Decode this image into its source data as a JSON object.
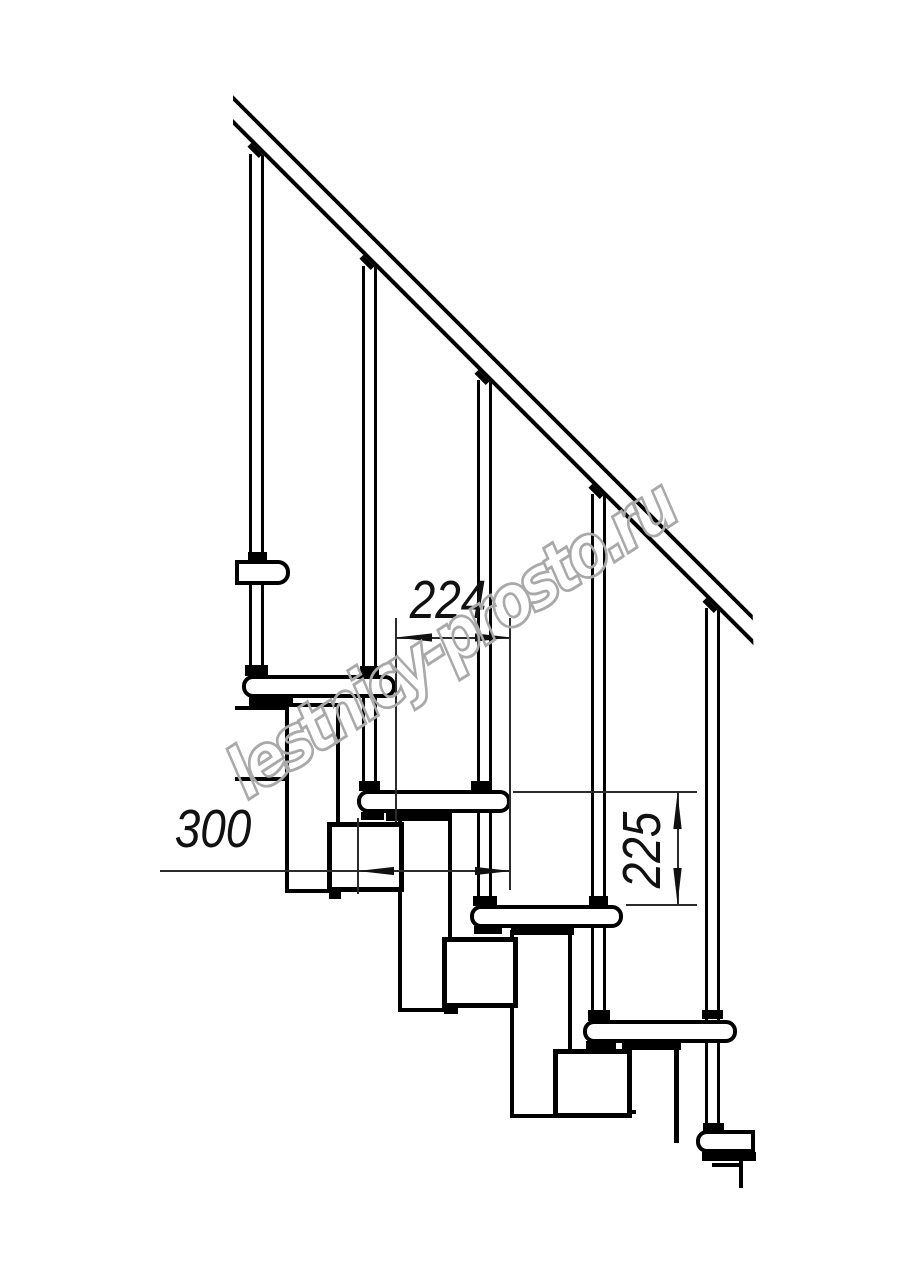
{
  "drawing": {
    "title": "Modular staircase side-view technical drawing",
    "background_color": "#ffffff",
    "line_color": "#000000",
    "dimension_color": "#2b2b2b",
    "dimensions": {
      "step_run": {
        "value": "224",
        "orientation": "horizontal"
      },
      "tread_depth": {
        "value": "300",
        "orientation": "horizontal"
      },
      "step_rise": {
        "value": "225",
        "orientation": "vertical"
      }
    },
    "parts": {
      "treads_visible": 5,
      "balusters_visible": 5,
      "handrail": "diagonal railing, 45 degrees",
      "spine": "stacked rectangular modules under treads"
    },
    "watermark": {
      "text": "lestnicy-prosto.ru",
      "outline_color": "#a9a9a9"
    }
  }
}
